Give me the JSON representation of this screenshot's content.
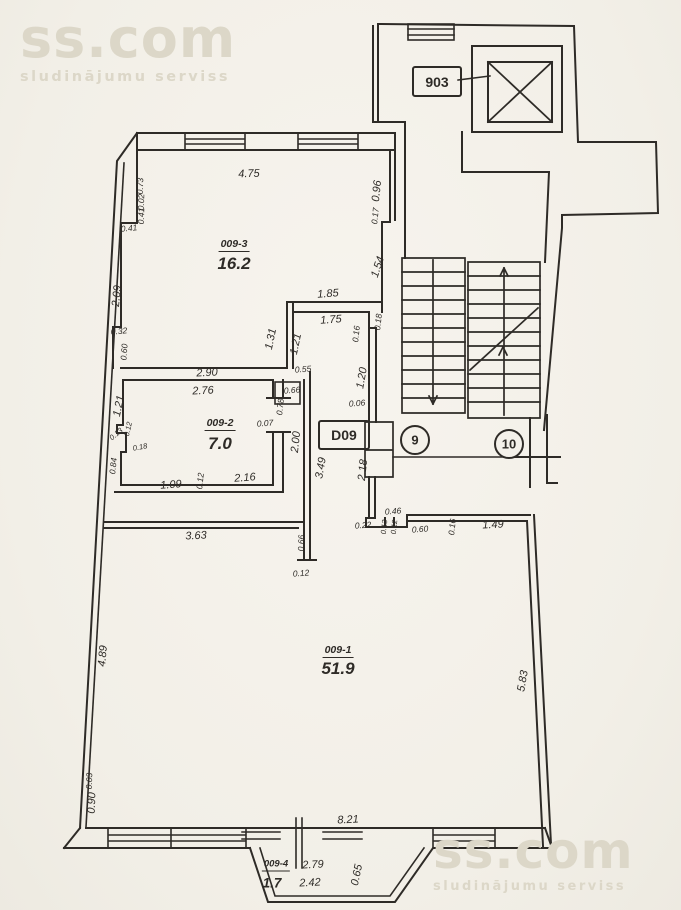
{
  "watermark": {
    "brand": "ss.com",
    "tagline": "sludinājumu serviss"
  },
  "unit_label": "903",
  "door_label": "D09",
  "stair_marks": {
    "nine": "9",
    "ten": "10"
  },
  "rooms": {
    "r3": {
      "code": "009-3",
      "area": "16.2"
    },
    "r2": {
      "code": "009-2",
      "area": "7.0"
    },
    "r1": {
      "code": "009-1",
      "area": "51.9"
    },
    "r4": {
      "code": "009-4",
      "area": "1.7"
    }
  },
  "dims": [
    "4.75",
    "0.73",
    "0.02",
    "0.41",
    "0.41",
    "2.09",
    "0.32",
    "0.60",
    "0.96",
    "0.17",
    "1.54",
    "1.85",
    "1.75",
    "1.31",
    "1.21",
    "0.55",
    "0.66",
    "2.90",
    "2.76",
    "1.21",
    "0.13",
    "0.12",
    "0.18",
    "0.84",
    "1.09",
    "0.12",
    "2.16",
    "0.07",
    "0.78",
    "2.00",
    "3.49",
    "2.18",
    "0.16",
    "0.18",
    "1.20",
    "0.06",
    "3.63",
    "0.66",
    "0.12",
    "0.46",
    "0.22",
    "0.13",
    "0.12",
    "0.60",
    "0.16",
    "1.49",
    "4.89",
    "5.83",
    "0.03",
    "0.90",
    "8.21",
    "2.79",
    "2.42",
    "0.65"
  ],
  "colors": {
    "paper": "#f4f1ea",
    "ink": "#2e2b27",
    "watermark": "#dcd7c8"
  }
}
